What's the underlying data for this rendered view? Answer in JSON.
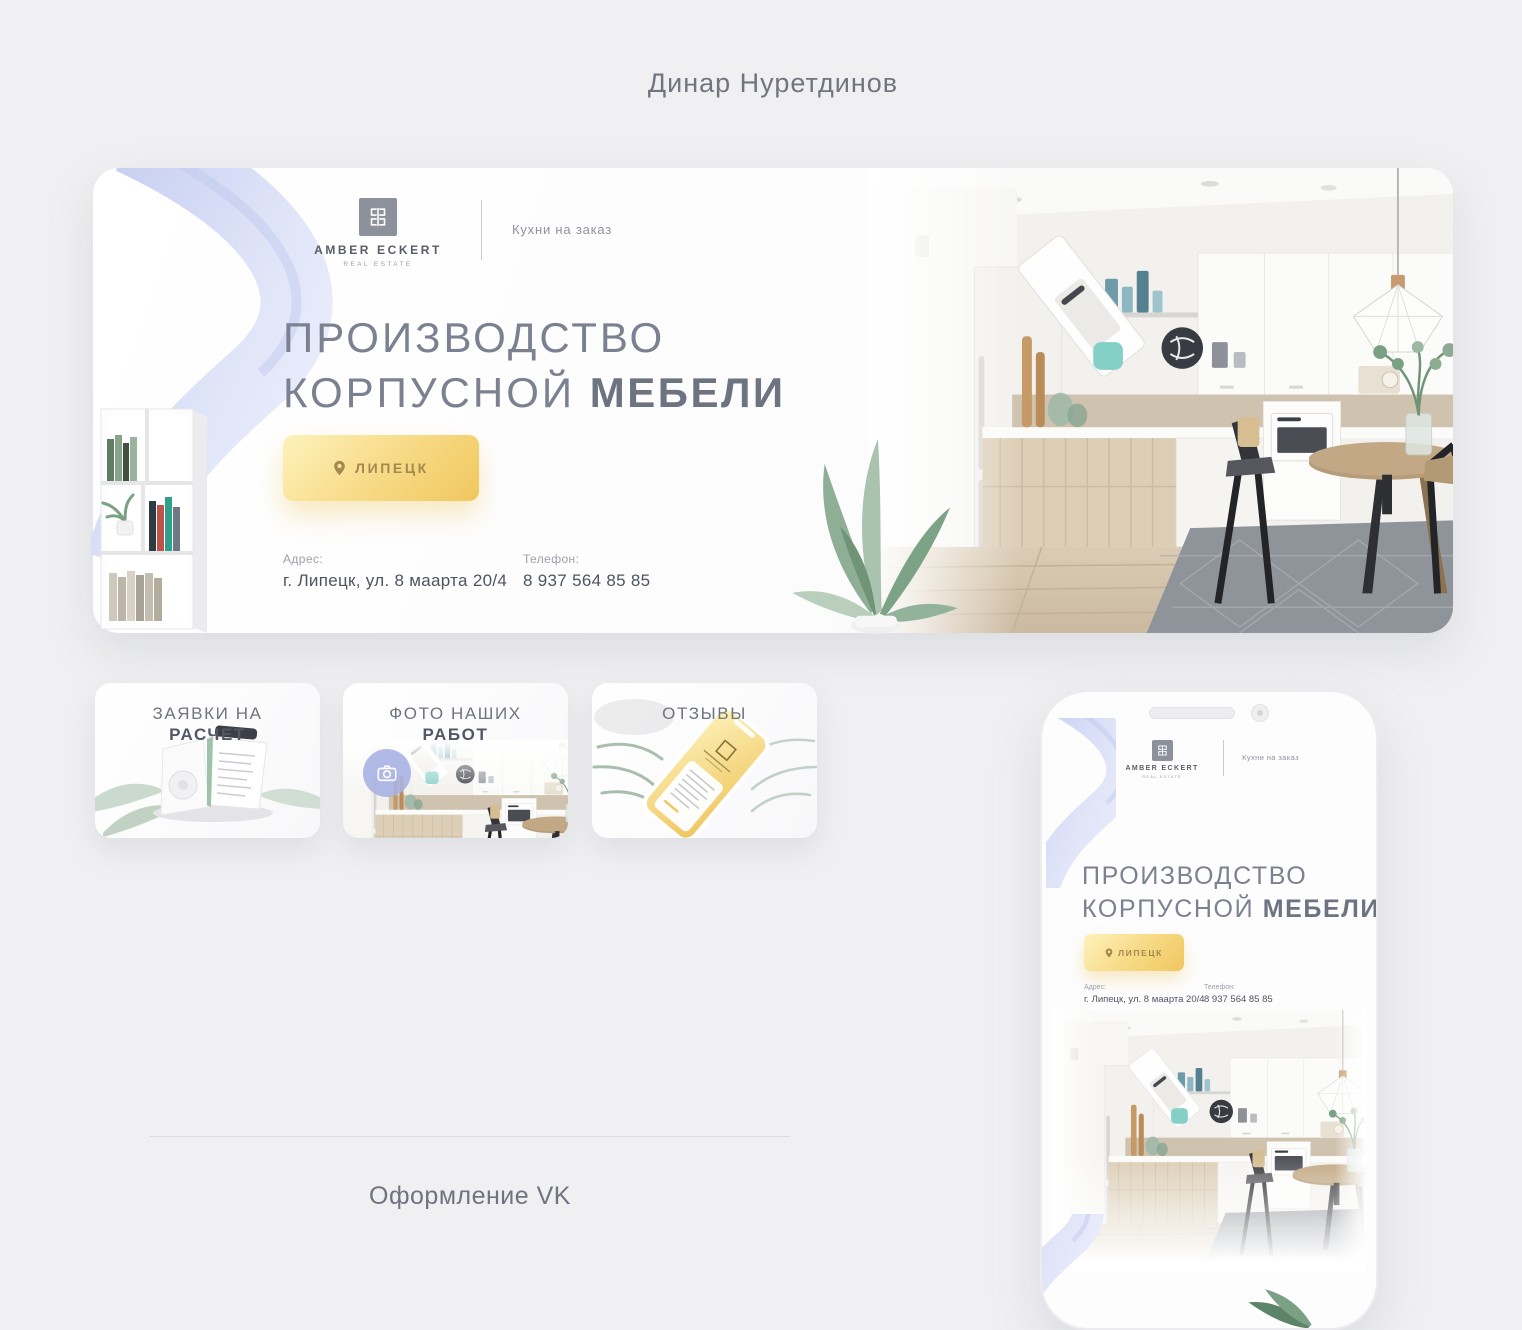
{
  "page": {
    "title": "Динар Нуретдинов",
    "footer_caption": "Оформление VK"
  },
  "banner": {
    "brand": {
      "name": "AMBER ECKERT",
      "subtitle": "REAL ESTATE",
      "category": "Кухни на заказ"
    },
    "heading": {
      "line1": "ПРОИЗВОДСТВО",
      "line2": "КОРПУСНОЙ",
      "line2_bold": "МЕБЕЛИ"
    },
    "location_button_label": "ЛИПЕЦК",
    "contacts": {
      "address_label": "Адрес:",
      "address": "г. Липецк, ул. 8 маарта 20/4",
      "phone_label": "Телефон:",
      "phone": "8 937 564 85 85"
    }
  },
  "menu_cards": [
    {
      "line1": "ЗАЯВКИ НА",
      "line2": "РАСЧЕТ"
    },
    {
      "line1": "ФОТО НАШИХ",
      "line2": "РАБОТ"
    },
    {
      "line1": "ОТЗЫВЫ",
      "line2": ""
    }
  ],
  "icons": {
    "location_pin": "map-pin drop shape",
    "camera": "photo camera outline",
    "brand_monogram": "mirrored double-bracket monogram"
  },
  "colors": {
    "page_bg": "#f0f0f2",
    "gold_light": "#fdf2bc",
    "gold": "#f0c75e",
    "gold_text": "#a3894d",
    "lavender": "#cbd3f2",
    "heading_gray": "#7b8190",
    "text_dark": "#4e5460",
    "text_muted": "#9ba0ab"
  }
}
